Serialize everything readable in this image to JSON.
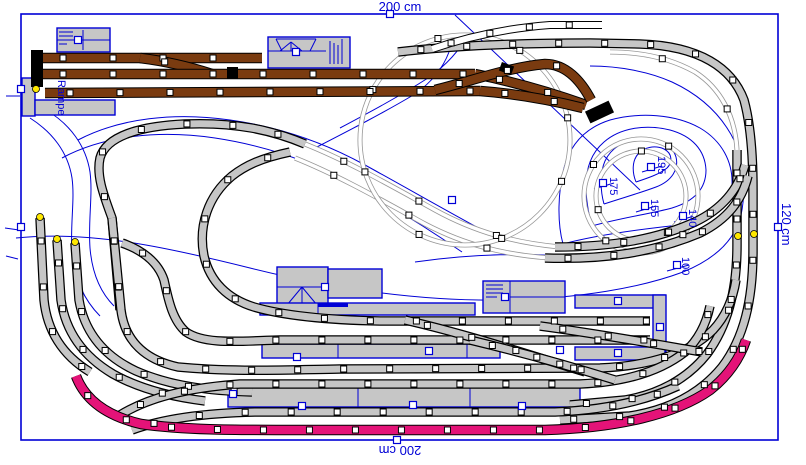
{
  "app": {
    "title": "track-plan-editor",
    "canvas_w": 806,
    "canvas_h": 465
  },
  "colors": {
    "blue": "#0000d6",
    "track_fill": "#c6c6c6",
    "outline": "#000000",
    "brown": "#7a3b10",
    "pink": "#e41378",
    "yellow": "#ffe800",
    "bg": "#ffffff"
  },
  "board": {
    "x": 21,
    "y": 14,
    "w": 757,
    "h": 426
  },
  "dimensions": {
    "top": {
      "text": "200 cm"
    },
    "bottom": {
      "text": "200 cm"
    },
    "right": {
      "text": "120 cm"
    }
  },
  "labels": {
    "ramp": {
      "text": "Rampe",
      "x": 55,
      "y": 80
    }
  },
  "elevations": [
    {
      "text": "195",
      "x": 655,
      "y": 156,
      "tick": [
        642,
        172,
        662,
        166
      ],
      "handle": [
        651,
        167
      ]
    },
    {
      "text": "175",
      "x": 607,
      "y": 177,
      "tick": [
        594,
        189,
        614,
        183
      ],
      "handle": [
        603,
        183
      ]
    },
    {
      "text": "155",
      "x": 648,
      "y": 199,
      "tick": [
        636,
        212,
        656,
        206
      ],
      "handle": [
        645,
        206
      ]
    },
    {
      "text": "140",
      "x": 686,
      "y": 209,
      "tick": [
        674,
        222,
        694,
        216
      ],
      "handle": [
        683,
        216
      ]
    },
    {
      "text": "100",
      "x": 679,
      "y": 257,
      "tick": [
        667,
        271,
        689,
        265
      ],
      "handle": [
        677,
        265
      ]
    }
  ],
  "contours": [
    "M 16,238 C 90,230 170,248 250,268 C 330,288 420,302 510,300 C 580,298 640,288 683,272 C 715,259 735,240 741,215 C 746,192 744,165 735,142 C 722,115 700,95 672,82 C 650,72 620,66 590,66",
    "M 563,244 C 600,234 650,228 689,224 C 716,220 730,205 732,185 C 733,162 722,141 700,128 C 675,114 640,112 610,120 C 585,128 570,145 564,168 C 558,192 557,222 563,244",
    "M 592,226 C 620,218 650,214 672,208 C 695,201 706,188 706,170 C 705,150 692,136 670,130 C 645,124 620,128 604,142 C 590,154 585,172 586,192 C 587,205 589,216 592,226",
    "M 604,204 C 622,198 640,193 656,187 C 672,181 679,169 676,157 C 672,144 658,138 641,139 C 624,140 611,148 605,161 C 600,172 600,190 604,204",
    "M 636,182 C 648,178 660,174 667,168 C 673,162 672,153 664,149 C 655,145 644,147 638,154 C 632,161 632,172 636,182",
    "M 30,118 C 52,132 68,152 72,178 C 75,200 70,225 72,252 C 74,278 84,300 100,316",
    "M 46,110 C 70,124 86,146 90,172 C 93,195 88,220 90,248 C 92,272 100,292 114,306",
    "M 78,140 C 120,118 175,112 230,120 C 280,127 325,143 365,165 C 405,187 445,210 482,230",
    "M 62,158 C 105,135 160,130 215,138 C 268,146 315,163 355,186 C 395,208 430,230 462,252",
    "M 340,128 C 370,112 400,96 428,78 C 448,64 460,50 468,34",
    "M 315,148 C 350,130 385,112 415,94 C 432,82 443,68 449,52",
    "M 455,15 L 640,190",
    "M 415,262 C 470,254 530,252 585,258"
  ],
  "border_ticks": [
    [
      6,
      96,
      20,
      96
    ],
    [
      5,
      228,
      19,
      230
    ],
    [
      6,
      256,
      18,
      259
    ]
  ],
  "buildings": [
    {
      "name": "goods-shed",
      "x": 57,
      "y": 28,
      "w": 53,
      "h": 24,
      "details": [
        [
          2,
          4,
          16,
          4
        ],
        [
          2,
          8,
          16,
          8
        ],
        [
          2,
          12,
          16,
          12
        ],
        [
          2,
          16,
          10,
          16
        ],
        [
          26,
          2,
          26,
          22
        ],
        [
          0,
          12,
          53,
          12
        ]
      ]
    },
    {
      "name": "station-building-top",
      "x": 268,
      "y": 37,
      "w": 82,
      "h": 31,
      "details": [
        [
          8,
          2,
          48,
          2
        ],
        [
          8,
          2,
          14,
          14
        ],
        [
          48,
          2,
          42,
          14
        ],
        [
          23,
          5,
          12,
          14
        ],
        [
          23,
          5,
          23,
          14
        ],
        [
          23,
          5,
          34,
          14
        ],
        [
          0,
          14,
          58,
          14
        ],
        [
          62,
          4,
          62,
          27
        ],
        [
          66,
          6,
          66,
          27
        ],
        [
          70,
          8,
          70,
          27
        ],
        [
          74,
          2,
          74,
          27
        ]
      ]
    },
    {
      "name": "ramp-block",
      "x": 22,
      "y": 78,
      "w": 13,
      "h": 38,
      "details": []
    },
    {
      "name": "ramp-platform",
      "x": 35,
      "y": 100,
      "w": 80,
      "h": 15,
      "details": []
    },
    {
      "name": "station-building-mid",
      "x": 277,
      "y": 267,
      "w": 51,
      "h": 40,
      "details": [
        [
          0,
          20,
          51,
          20
        ],
        [
          25,
          20,
          10,
          38
        ],
        [
          25,
          20,
          25,
          38
        ],
        [
          25,
          20,
          40,
          38
        ]
      ]
    },
    {
      "name": "station-annex",
      "x": 328,
      "y": 269,
      "w": 54,
      "h": 29,
      "details": []
    },
    {
      "name": "engine-shed",
      "x": 483,
      "y": 281,
      "w": 82,
      "h": 32,
      "details": [
        [
          3,
          4,
          20,
          4
        ],
        [
          3,
          8,
          20,
          8
        ],
        [
          3,
          12,
          20,
          12
        ],
        [
          3,
          16,
          14,
          16
        ],
        [
          27,
          0,
          27,
          32
        ],
        [
          27,
          16,
          82,
          16
        ]
      ]
    },
    {
      "name": "platform-upper",
      "x": 260,
      "y": 303,
      "w": 215,
      "h": 12,
      "details": [
        [
          58,
          0,
          58,
          12
        ]
      ]
    },
    {
      "name": "platform-middle",
      "x": 262,
      "y": 344,
      "w": 238,
      "h": 14,
      "details": [
        [
          76,
          0,
          76,
          14
        ],
        [
          205,
          0,
          205,
          14
        ]
      ]
    },
    {
      "name": "platform-lower",
      "x": 228,
      "y": 386,
      "w": 352,
      "h": 21,
      "details": [
        [
          130,
          0,
          130,
          21
        ],
        [
          242,
          0,
          242,
          21
        ]
      ]
    },
    {
      "name": "terminal-platform-top",
      "x": 575,
      "y": 295,
      "w": 90,
      "h": 13,
      "details": []
    },
    {
      "name": "terminal-platform-right",
      "x": 653,
      "y": 295,
      "w": 13,
      "h": 65,
      "details": []
    },
    {
      "name": "terminal-platform-bottom",
      "x": 575,
      "y": 347,
      "w": 90,
      "h": 13,
      "details": []
    }
  ],
  "blue_bar": {
    "x": 318,
    "y": 303,
    "w": 30,
    "h": 4
  },
  "tracks": {
    "thick_gray": [
      "M 398,52 C 450,46 520,43 590,43 L 640,44 C 700,46 732,68 744,100 C 750,122 753,150 753,190 L 753,250 C 753,300 744,338 722,367 C 700,394 668,410 630,416 L 560,420",
      "M 737,150 L 737,245 C 737,292 727,327 707,354 C 688,378 660,394 625,400 L 570,405",
      "M 120,310 L 112,218 C 104,196 96,176 100,158 C 106,136 140,126 185,124 C 235,122 272,130 305,144",
      "M 555,247 C 610,247 655,240 695,222 C 722,209 738,190 745,165",
      "M 545,258 C 605,260 655,252 700,233 C 728,219 742,200 748,176",
      "M 40,218 L 44,300 C 47,330 62,355 90,372",
      "M 57,240 L 61,300 C 66,335 86,358 113,374 C 140,389 172,397 205,401",
      "M 75,243 L 79,300 C 85,335 106,357 136,371 C 170,386 210,391 252,392",
      "M 112,218 L 121,310 C 125,342 146,360 178,367 C 230,372 280,370 340,369 L 600,368 C 650,366 690,353 713,330 C 726,316 733,299 736,280",
      "M 122,243 C 142,250 158,262 164,280 C 168,298 172,320 186,332 C 205,345 240,341 280,340 L 650,340",
      "M 290,152 C 262,158 246,165 232,176 C 208,196 198,226 204,256 C 210,282 228,299 254,307 C 285,316 330,320 380,321 L 650,321",
      "M 120,415 C 148,398 185,388 240,384 L 580,384 C 628,382 662,370 685,352 C 698,340 706,325 710,306",
      "M 132,430 C 162,419 205,413 255,412 L 555,412 C 605,410 645,401 678,386",
      "M 405,320 C 470,335 530,355 585,372",
      "M 540,326 C 600,334 655,344 702,352",
      "M 470,340 C 520,352 570,366 615,380"
    ],
    "thin_gray": [
      "M 305,144 C 350,162 395,188 435,210 C 475,232 515,243 560,247",
      "M 295,158 C 340,176 385,202 425,224 C 465,245 505,255 550,258",
      "M 737,150 C 735,115 720,88 695,72 C 670,58 640,52 610,52",
      "M 570,140 A 105,105 0 1 1 360,140 A 105,105 0 1 1 570,140",
      "M 698,196 A 57,57 0 1 1 584,196 A 57,57 0 1 1 698,196",
      "M 686,196 A 45,45 0 1 1 596,196 A 45,45 0 1 1 686,196"
    ],
    "white_style": [
      "M 432,49 C 470,36 510,28 550,25 L 602,25"
    ],
    "brown": [
      "M 38,58 L 262,58",
      "M 140,58 C 165,61 190,67 212,74",
      "M 38,74 L 475,74",
      "M 475,74 C 515,82 555,94 586,105",
      "M 45,93 L 480,91",
      "M 480,91 C 520,94 555,101 583,108",
      "M 435,90 C 475,80 510,67 545,64 C 566,64 581,81 591,100"
    ],
    "pink": [
      "M 76,376 C 85,400 107,416 141,424 C 184,430 234,430 284,430 L 545,430 C 618,428 676,414 710,390 C 728,376 740,358 746,340"
    ]
  },
  "buffers": [
    {
      "x": 31,
      "y": 50,
      "w": 12,
      "h": 37,
      "rot": 0
    },
    {
      "x": 593,
      "y": 99,
      "w": 13,
      "h": 26,
      "rot": 65
    },
    {
      "x": 227,
      "y": 67,
      "w": 11,
      "h": 12,
      "rot": 0
    },
    {
      "x": 500,
      "y": 64,
      "w": 13,
      "h": 9,
      "rot": 20
    }
  ],
  "yellow_dots": [
    [
      36,
      89
    ],
    [
      40,
      217
    ],
    [
      57,
      239
    ],
    [
      75,
      242
    ],
    [
      738,
      236
    ],
    [
      754,
      234
    ]
  ],
  "blue_handles": [
    [
      390,
      14
    ],
    [
      778,
      227
    ],
    [
      397,
      440
    ],
    [
      21,
      89
    ],
    [
      21,
      227
    ],
    [
      78,
      40
    ],
    [
      296,
      52
    ],
    [
      325,
      287
    ],
    [
      505,
      297
    ],
    [
      618,
      301
    ],
    [
      660,
      327
    ],
    [
      618,
      353
    ],
    [
      297,
      357
    ],
    [
      429,
      351
    ],
    [
      560,
      350
    ],
    [
      302,
      406
    ],
    [
      413,
      405
    ],
    [
      522,
      406
    ],
    [
      233,
      394
    ],
    [
      452,
      200
    ]
  ]
}
